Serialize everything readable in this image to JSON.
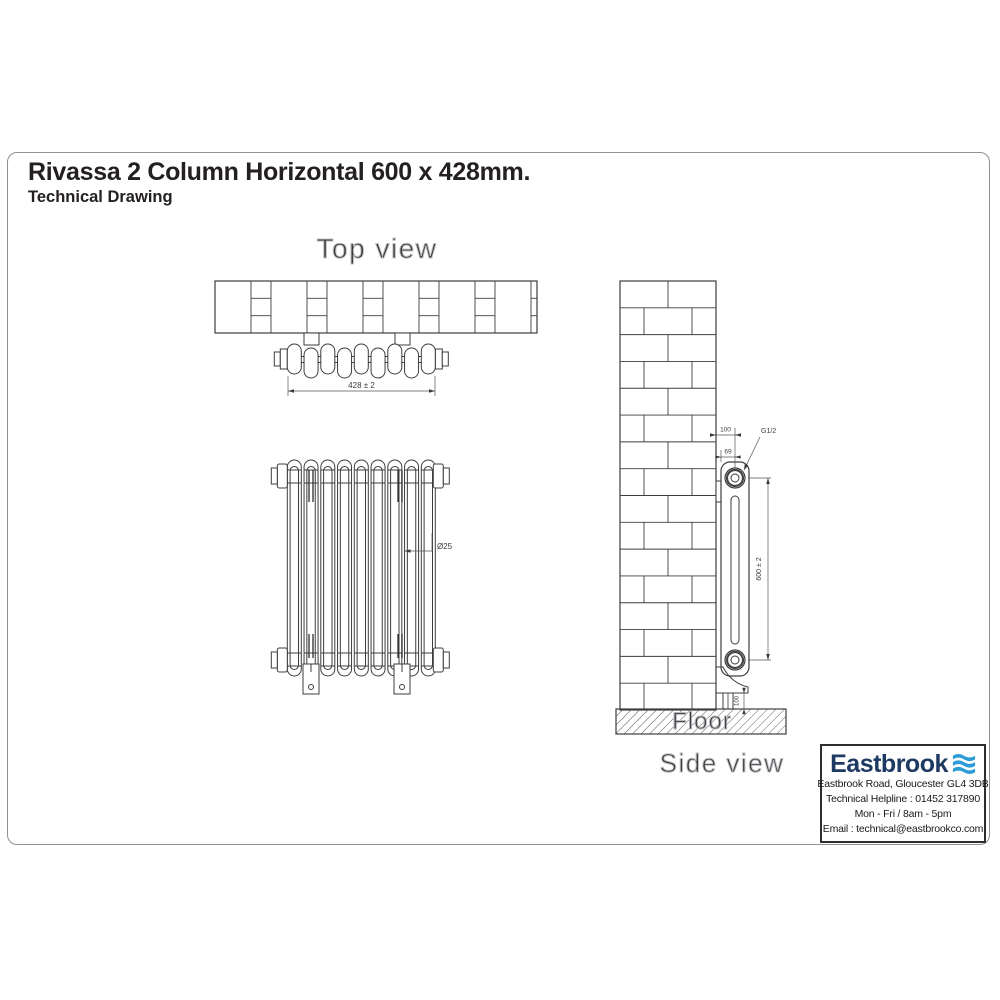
{
  "page": {
    "title": "Rivassa 2 Column Horizontal 600 x 428mm.",
    "subtitle": "Technical Drawing"
  },
  "views": {
    "top_label": "Top view",
    "side_label": "Side view",
    "floor_label": "Floor"
  },
  "dimensions": {
    "width": "428 ± 2",
    "column_diameter": "Ø25",
    "wall_to_pipe_center": "100",
    "bracket_depth": "69",
    "connection_thread": "G1/2",
    "height": "600 ± 2",
    "floor_clearance": "100"
  },
  "company": {
    "name": "Eastbrook",
    "address": "Eastbrook Road, Gloucester GL4 3DB",
    "helpline": "Technical Helpline : 01452 317890",
    "hours": "Mon - Fri / 8am - 5pm",
    "email": "Email : technical@eastbrookco.com",
    "brand_navy": "#1e3a63",
    "brand_blue": "#2b9cd8",
    "line_color": "#3d3d3d",
    "outline_text_color": "#c3c3c8"
  }
}
